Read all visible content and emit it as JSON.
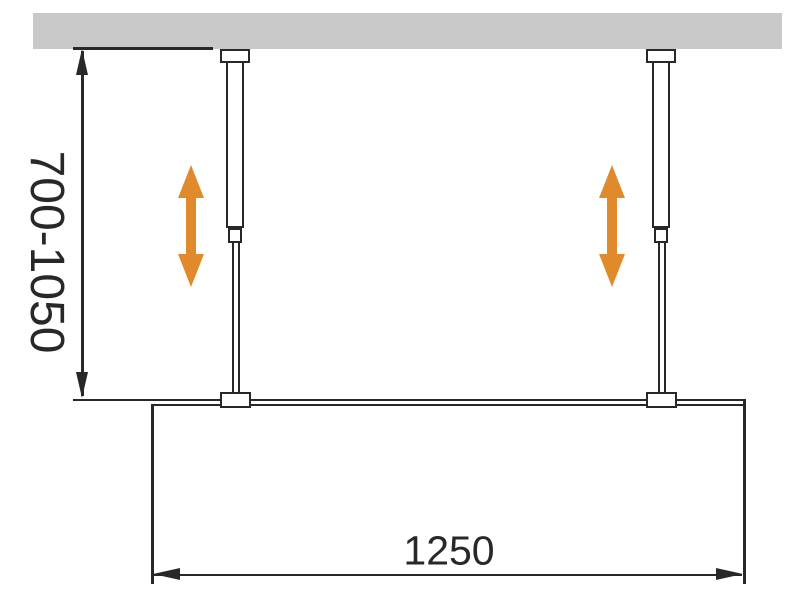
{
  "diagram": {
    "kind": "installation drawing",
    "subject": "walk-in glass panel fixed to ceiling with two adjustable support bars",
    "dimensions": {
      "height_range": {
        "label": "700-1050",
        "orientation": "vertical"
      },
      "width": {
        "label": "1250",
        "orientation": "horizontal"
      }
    },
    "colors": {
      "background": "#ffffff",
      "ceiling": "#c9c9c9",
      "line": "#2a2827",
      "arrow": "#e08a2c"
    },
    "icons": {
      "adjust_arrow": "vertical-double-headed-arrow",
      "dimension_arrowheads": "filled-triangles"
    }
  }
}
